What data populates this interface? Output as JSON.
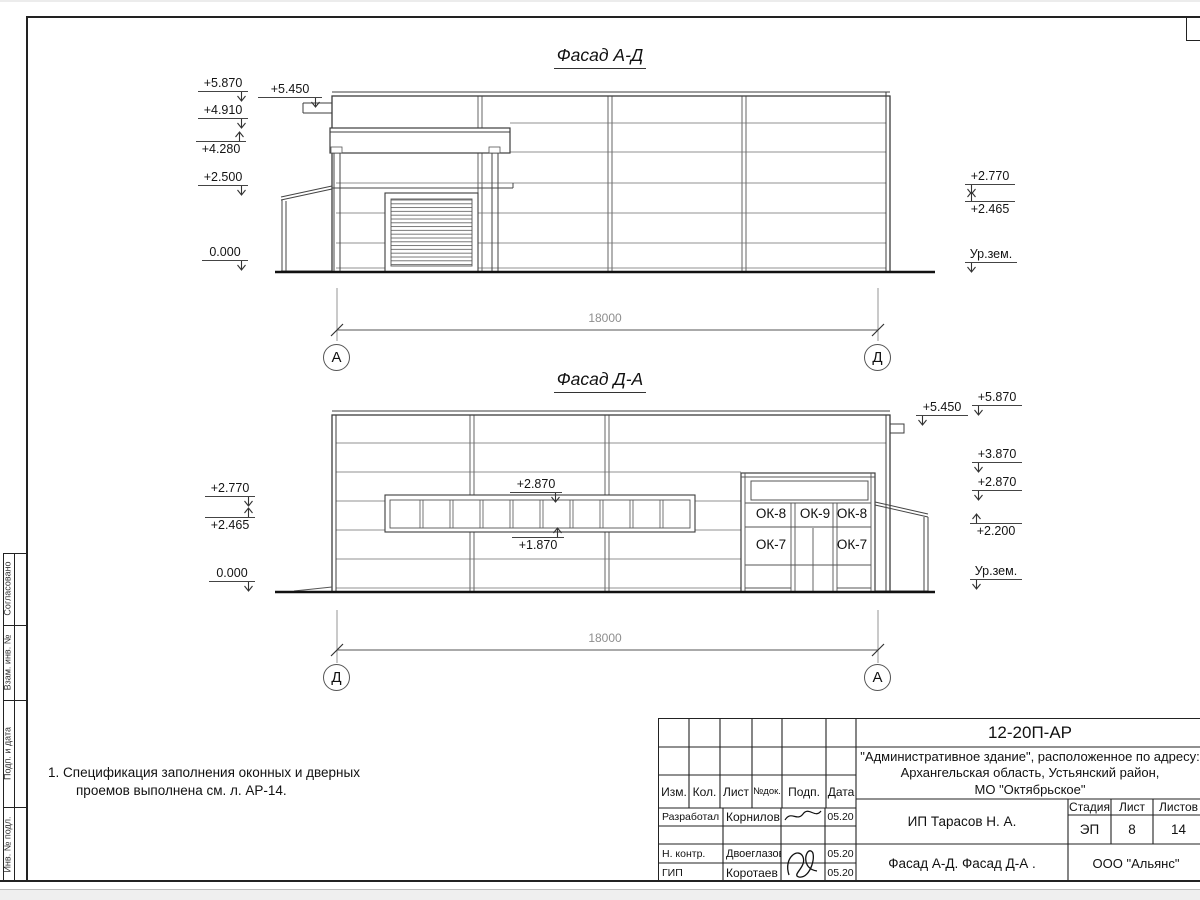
{
  "sheet": {
    "note": {
      "line1": "1. Спецификация заполнения оконных и дверных",
      "line2": "проемов выполнена см. л. АР-14."
    },
    "side_strip": {
      "cell1": "Согласовано",
      "cell2": "Взам. инв. №",
      "cell3": "Подп. и дата",
      "cell4": "Инв. № подл."
    }
  },
  "facade1": {
    "title": "Фасад А-Д",
    "elev": {
      "l1": "+5.870",
      "l2": "+4.910",
      "l3": "+4.280",
      "l4": "+2.500",
      "l5": "0.000",
      "l6": "+5.450",
      "r1": "+2.770",
      "r2": "+2.465",
      "ground": "Ур.зем."
    },
    "axis_left": "А",
    "axis_right": "Д",
    "dim": "18000"
  },
  "facade2": {
    "title": "Фасад Д-А",
    "elev": {
      "l1": "+2.770",
      "l2": "+2.465",
      "l3": "0.000",
      "m1": "+2.870",
      "m2": "+1.870",
      "r1": "+5.870",
      "r2": "+5.450",
      "r3": "+3.870",
      "r4": "+2.870",
      "r5": "+2.200",
      "ground": "Ур.зем."
    },
    "windows": {
      "w1": "ОК-8",
      "w2": "ОК-9",
      "w3": "ОК-8",
      "w4": "ОК-7",
      "w5": "ОК-7"
    },
    "axis_left": "Д",
    "axis_right": "А",
    "dim": "18000"
  },
  "titleblock": {
    "doc_number": "12-20П-АР",
    "address1": "\"Административное здание\", расположенное по адресу:",
    "address2": "Архангельская область, Устьянский район,",
    "address3": "МО \"Октябрьское\"",
    "cols": {
      "c1": "Изм.",
      "c2": "Кол.",
      "c3": "Лист",
      "c4": "№док.",
      "c5": "Подп.",
      "c6": "Дата"
    },
    "rows": {
      "r1_role": "Разработал",
      "r1_name": "Корнилов",
      "r1_date": "05.20",
      "r3_role": "Н. контр.",
      "r3_name": "Двоеглазов",
      "r3_date": "05.20",
      "r4_role": "ГИП",
      "r4_name": "Коротаев",
      "r4_date": "05.20"
    },
    "client": "ИП Тарасов Н. А.",
    "stage_label": "Стадия",
    "sheet_label": "Лист",
    "sheets_label": "Листов",
    "stage": "ЭП",
    "sheet_no": "8",
    "sheets_total": "14",
    "sheet_title": "Фасад А-Д. Фасад Д-А .",
    "company": "ООО \"Альянс\""
  }
}
